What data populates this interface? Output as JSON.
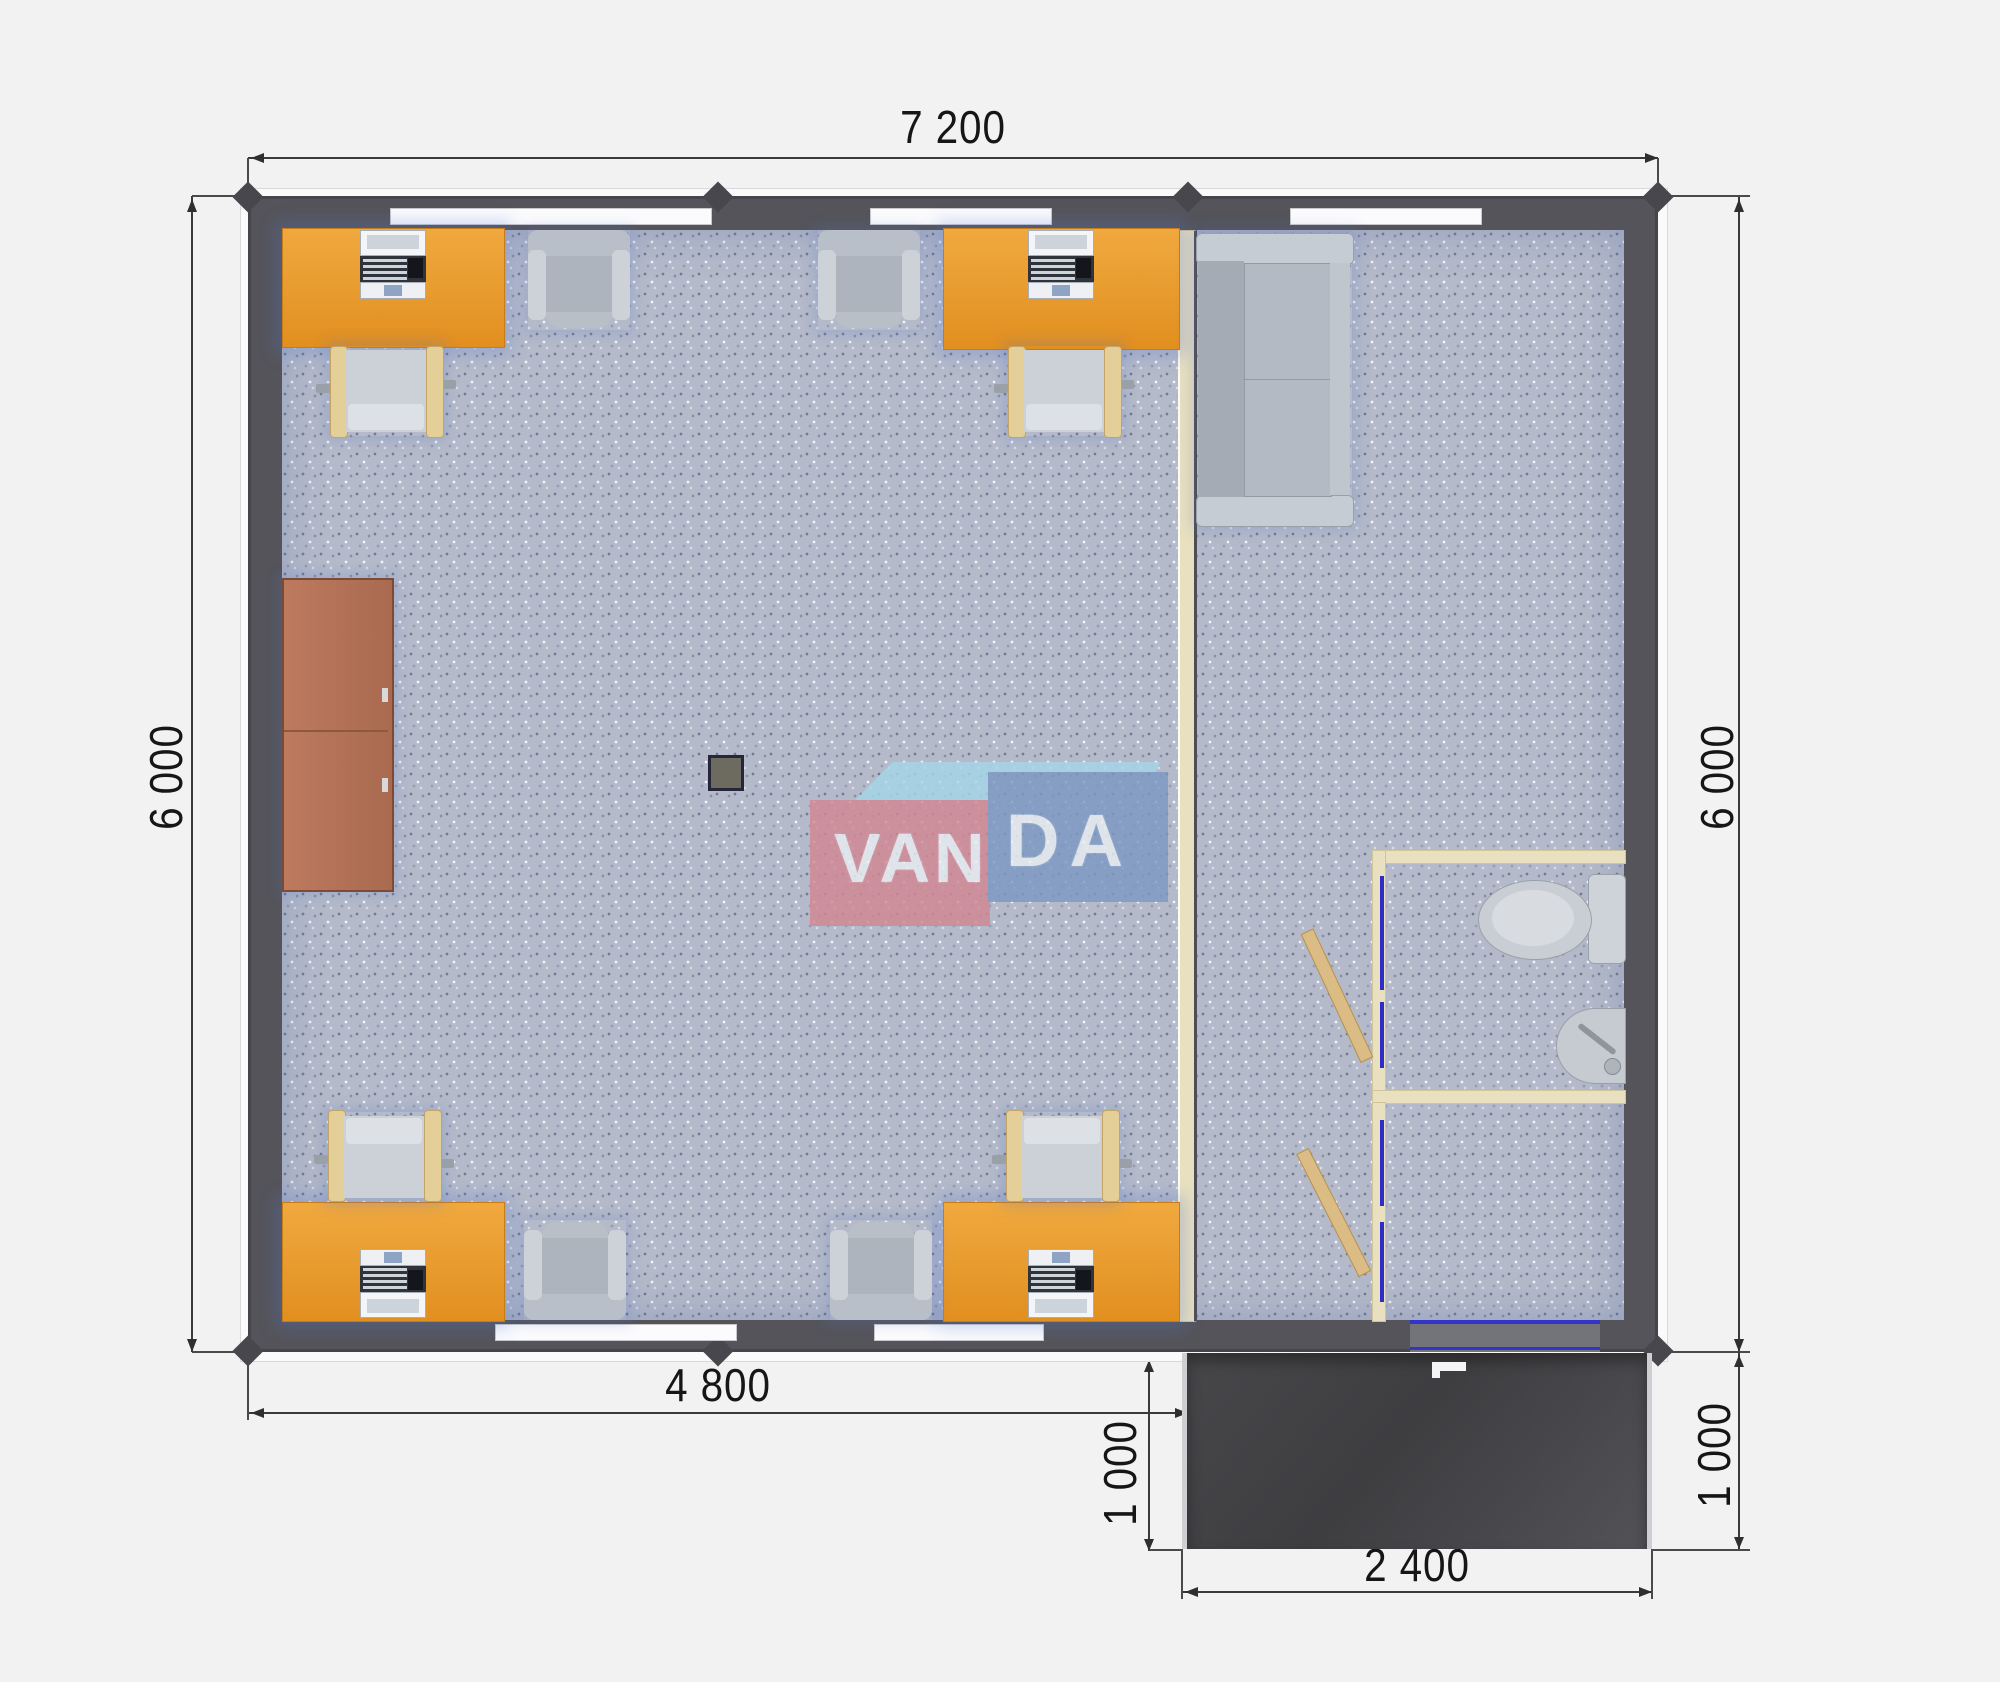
{
  "page": {
    "kind": "modular office floor plan, top view render",
    "background": "#f2f2f3"
  },
  "dimensions": {
    "top_width": "7 200",
    "left_height": "6 000",
    "right_height": "6 000",
    "main_room_width": "4 800",
    "porch_depth_left": "1 000",
    "porch_depth_right": "1 000",
    "porch_width": "2 400"
  },
  "logo": {
    "part1": "VAN",
    "part2": "DA",
    "colors": {
      "pink": "#d28794",
      "blue": "#7d99c3",
      "light_blue": "#a6d6e9",
      "text": "#e9eef3"
    }
  },
  "colors": {
    "wall": "#54545a",
    "floor": "#b4bac9",
    "desk_orange": "#e8952f",
    "cabinet_brown": "#b5735a",
    "partition_tan": "#e9e0c0",
    "door_frame_blue": "#2e2ec6",
    "door_leaf_tan": "#dbbc85",
    "porch_dark": "#454548",
    "furniture_gray": "#c3c9d0"
  },
  "furniture": {
    "office_desks": 4,
    "desktop_computers": 4,
    "task_chairs": 4,
    "guest_armchairs": 4,
    "storage_cabinet": 1,
    "sofa": 1,
    "toilet": 1,
    "corner_sink": 1,
    "support_column": 1,
    "interior_doors": 2,
    "entrance_porch": 1
  }
}
